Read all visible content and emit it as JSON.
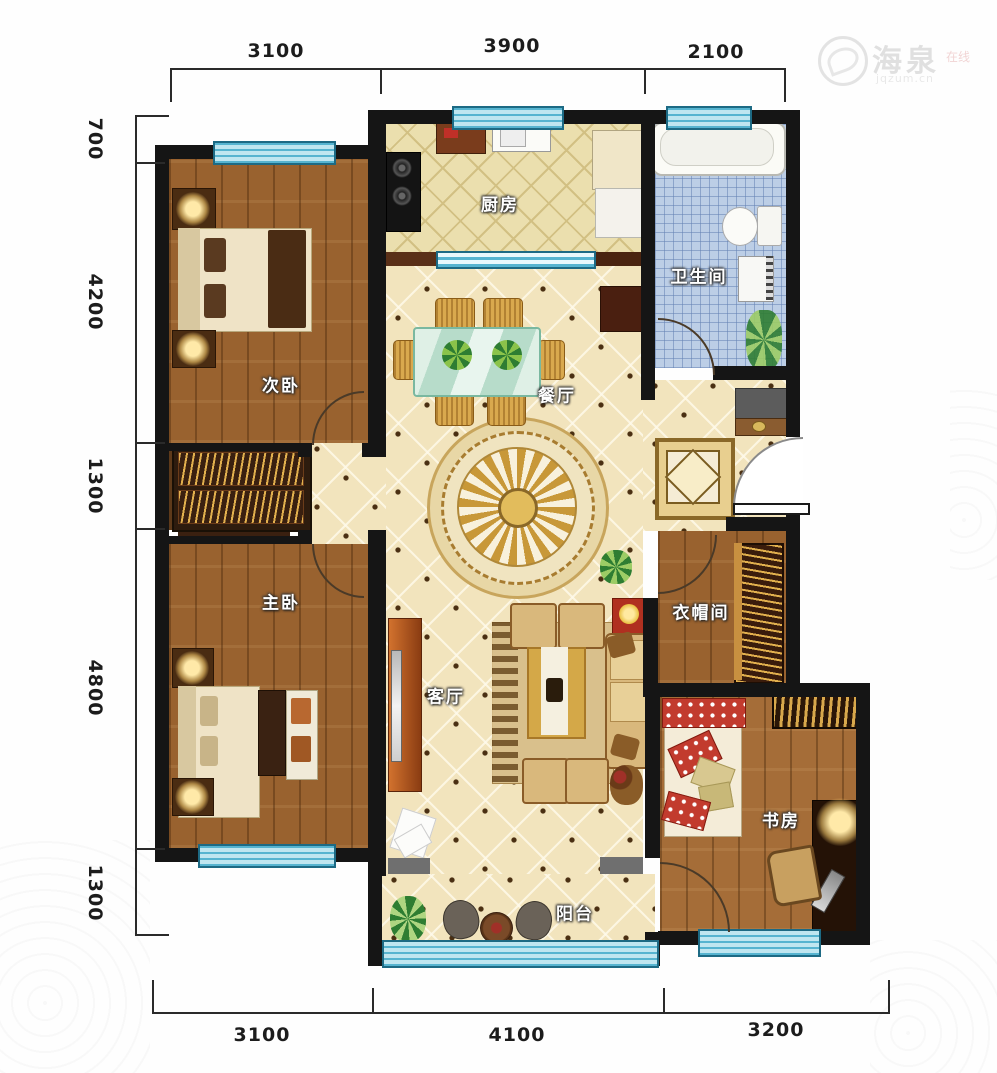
{
  "watermark": {
    "brand": "海泉",
    "tag": "在线",
    "site": "jqzum.cn"
  },
  "dims": {
    "top": [
      "3100",
      "3900",
      "2100"
    ],
    "left": [
      "700",
      "4200",
      "1300",
      "4800",
      "1300"
    ],
    "bottom": [
      "3100",
      "4100",
      "3200"
    ]
  },
  "rooms": {
    "kitchen": "厨房",
    "bathroom": "卫生间",
    "bedroom2": "次卧",
    "dining": "餐厅",
    "master": "主卧",
    "living": "客厅",
    "cloakroom": "衣帽间",
    "study": "书房",
    "balcony": "阳台"
  },
  "colors": {
    "wall": "#151515",
    "window": "#bfe6f0",
    "tile": "#f2e4bd",
    "bath_tile": "#bccee6",
    "wood": "#99622f"
  }
}
